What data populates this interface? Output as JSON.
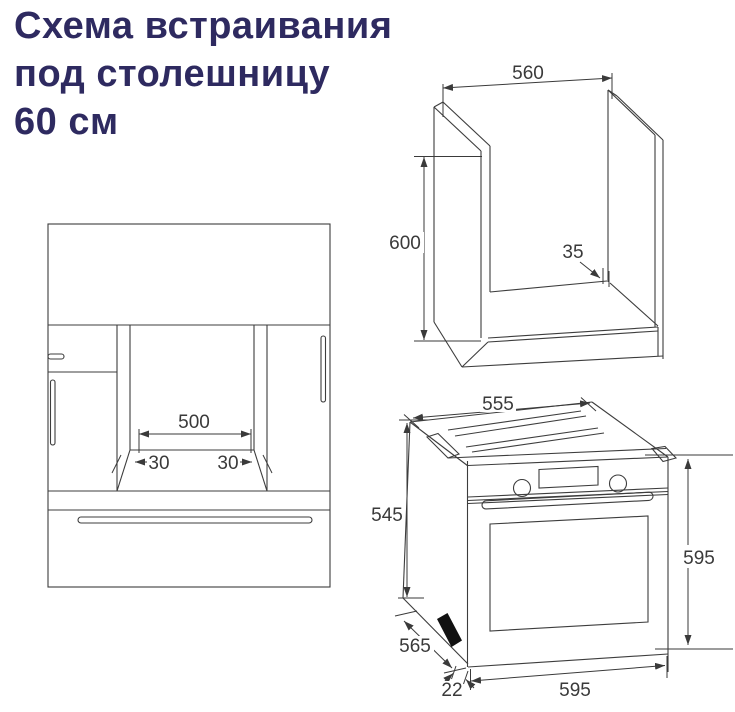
{
  "title": {
    "line1": "Схема встраивания",
    "line2": "под столешницу",
    "line3": "60 см"
  },
  "colors": {
    "title_text": "#2e2a60",
    "drawing_line": "#3d3d3d",
    "dimension_text": "#3a3a3a",
    "vent_fill": "#111111",
    "background": "#ffffff"
  },
  "figures": {
    "front_view": {
      "description": "cabinet front view with oven niche",
      "labels": {
        "niche_width": "500",
        "left_offset": "30",
        "right_offset": "30"
      }
    },
    "cabinet_niche": {
      "description": "3d view of cabinet niche carcass",
      "labels": {
        "width": "560",
        "height": "600",
        "rear_gap": "35"
      }
    },
    "oven": {
      "description": "3d view of built-in oven",
      "labels": {
        "top_width": "555",
        "body_height": "545",
        "front_height": "595",
        "body_depth": "565",
        "door_protrusion": "22",
        "front_width": "595"
      }
    }
  }
}
